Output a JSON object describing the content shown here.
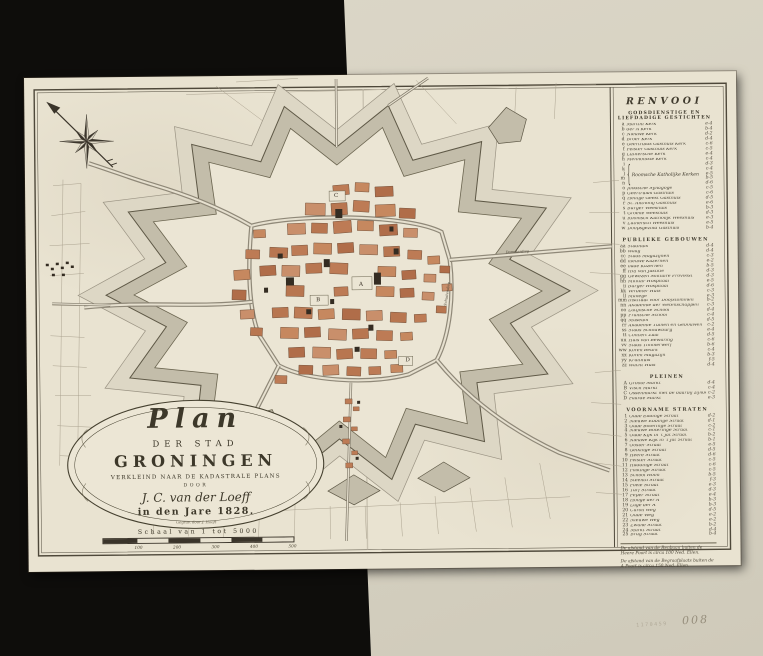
{
  "stamp": {
    "number": "1170459",
    "code": "008"
  },
  "cartouche": {
    "title_script": "Plan",
    "line_der_stad": "DER STAD",
    "city": "GRONINGEN",
    "subtitle": "VERKLEIND NAAR DE KADASTRALE PLANS",
    "door": "DOOR",
    "author": "J. C. van der Loeff",
    "year_line": "in den Jare 1828.",
    "engraver": "Gegrav. door J. Hooft",
    "scale_label": "Schaal van 1 tot 5000",
    "scale_ticks": [
      "100",
      "200",
      "300",
      "400",
      "500"
    ]
  },
  "legend": {
    "title": "RENVOOI",
    "sections": [
      {
        "header": [
          "GODSDIENSTIGE EN",
          "LIEFDADIGE GESTICHTEN"
        ],
        "items": [
          {
            "k": "a",
            "n": "Martini Kerk",
            "r": "e-4"
          },
          {
            "k": "b",
            "n": "der A Kerk",
            "r": "b-4"
          },
          {
            "k": "c",
            "n": "Nieuwe Kerk",
            "r": "d-2"
          },
          {
            "k": "d",
            "n": "Broer Kerk",
            "r": "d-4"
          },
          {
            "k": "e",
            "n": "Geertruids Gasthuis Kerk",
            "r": "c-6"
          },
          {
            "k": "f",
            "n": "Pelster Gasthuis Kerk",
            "r": "c-5"
          },
          {
            "k": "g",
            "n": "Luthersche Kerk",
            "r": "e-4"
          },
          {
            "k": "h",
            "n": "Mennoniste Kerk",
            "r": "c-4"
          }
        ],
        "group": {
          "keys": [
            "i",
            "k",
            "l",
            "m",
            "n"
          ],
          "name": "Roomsche Katholijke Kerken",
          "refs": [
            "d-3",
            "c-4",
            "e-5",
            "b-5",
            "d-6"
          ]
        },
        "items2": [
          {
            "k": "o",
            "n": "Joodsche Synagoge",
            "r": "c-5"
          },
          {
            "k": "p",
            "n": "Geertruids Gasthuis",
            "r": "c-6"
          },
          {
            "k": "q",
            "n": "Heilige Geest Gasthuis",
            "r": "d-5"
          },
          {
            "k": "r",
            "n": "St. Anthonij Gasthuis",
            "r": "e-6"
          },
          {
            "k": "s",
            "n": "Burger Weeshuis",
            "r": "b-3"
          },
          {
            "k": "t",
            "n": "Groene Weeshuis",
            "r": "d-3"
          },
          {
            "k": "u",
            "n": "Roomsch Katholijk Weeshuis",
            "r": "e-3"
          },
          {
            "k": "v",
            "n": "Luthersch Weeshuis",
            "r": "e-5"
          },
          {
            "k": "w",
            "n": "Doopsgezind Gasthuis",
            "r": "b-4"
          }
        ]
      },
      {
        "header": [
          "PUBLIEKE GEBOUWEN"
        ],
        "items": [
          {
            "k": "aa",
            "n": "Stadhuis",
            "r": "d-4"
          },
          {
            "k": "bb",
            "n": "Waag",
            "r": "d-4"
          },
          {
            "k": "cc",
            "n": "Stads Magazijnen",
            "r": "c-3"
          },
          {
            "k": "dd",
            "n": "nieuwe Kazernen",
            "r": "e-2"
          },
          {
            "k": "ee",
            "n": "oude Kazernen",
            "r": "b-5"
          },
          {
            "k": "ff",
            "n": "Hof van Justitie",
            "r": "d-3"
          },
          {
            "k": "gg",
            "n": "Gewezen Militaire Provoost",
            "r": "d-3"
          },
          {
            "k": "hh",
            "n": "Militair Hospitaal",
            "r": "e-5"
          },
          {
            "k": "ii",
            "n": "Burger Hospitaal",
            "r": "d-6"
          },
          {
            "k": "kk",
            "n": "Verbeter Huis",
            "r": "c-3"
          },
          {
            "k": "ll",
            "n": "Manege",
            "r": "e-3"
          },
          {
            "k": "mm",
            "n": "Instituut voor Doofstommen",
            "r": "b-2"
          },
          {
            "k": "nn",
            "n": "Akademie der Wetenschappen",
            "r": "c-3"
          },
          {
            "k": "oo",
            "n": "Latijnsche School",
            "r": "d-4"
          },
          {
            "k": "pp",
            "n": "Fransche School",
            "r": "c-4"
          },
          {
            "k": "qq",
            "n": "Museum",
            "r": "d-5"
          },
          {
            "k": "rr",
            "n": "Akademie Tuinen en Gebouwen",
            "r": "c-2"
          },
          {
            "k": "ss",
            "n": "Stads Schouwburg",
            "r": "e-4"
          },
          {
            "k": "tt",
            "n": "Concert Zaal",
            "r": "d-5"
          },
          {
            "k": "uu",
            "n": "Huis van Bewaring",
            "r": "c-6"
          },
          {
            "k": "vv",
            "n": "Stads Timmerwerf",
            "r": "b-6"
          },
          {
            "k": "ww",
            "n": "Koren Beurs",
            "r": "c-4"
          },
          {
            "k": "xx",
            "n": "Koren Magazijn",
            "r": "b-3"
          },
          {
            "k": "yy",
            "n": "Kruithuis",
            "r": "f-5"
          },
          {
            "k": "zz",
            "n": "Wacht Huis",
            "r": "d-4"
          }
        ]
      },
      {
        "header": [
          "PLEINEN"
        ],
        "items": [
          {
            "k": "A",
            "n": "Groote Markt",
            "r": "d-4"
          },
          {
            "k": "B",
            "n": "Visch Markt",
            "r": "c-4"
          },
          {
            "k": "C",
            "n": "Ossenmarkt met de daarbij zijnde Exercitieplaats",
            "r": "c-2"
          },
          {
            "k": "D",
            "n": "Paarde Markt",
            "r": "e-3"
          }
        ]
      },
      {
        "header": [
          "VOORNAME STRATEN"
        ],
        "items": [
          {
            "k": "1",
            "n": "Oude Ebbinge Straat",
            "r": "d-2"
          },
          {
            "k": "2",
            "n": "Nieuwe Ebbinge Straat",
            "r": "d-1"
          },
          {
            "k": "3",
            "n": "Oude Boteringe Straat",
            "r": "c-2"
          },
          {
            "k": "4",
            "n": "Nieuwe Boteringe Straat",
            "r": "c-1"
          },
          {
            "k": "5",
            "n": "Oude Kijk in 't Jat Straat",
            "r": "b-2"
          },
          {
            "k": "6",
            "n": "Nieuwe Kijk in 't Jat Straat",
            "r": "b-1"
          },
          {
            "k": "7",
            "n": "Ooster Straat",
            "r": "e-5"
          },
          {
            "k": "8",
            "n": "Gelkinge Straat",
            "r": "d-5"
          },
          {
            "k": "9",
            "n": "Heere Straat",
            "r": "d-6"
          },
          {
            "k": "10",
            "n": "Pelster Straat",
            "r": "c-5"
          },
          {
            "k": "11",
            "n": "Haddinge Straat",
            "r": "c-6"
          },
          {
            "k": "12",
            "n": "Folkinge Straat",
            "r": "c-5"
          },
          {
            "k": "13",
            "n": "School Holm",
            "r": "b-5"
          },
          {
            "k": "14",
            "n": "Steentil Straat",
            "r": "f-3"
          },
          {
            "k": "15",
            "n": "Poele Straat",
            "r": "e-3"
          },
          {
            "k": "16",
            "n": "Turf Straat",
            "r": "d-3"
          },
          {
            "k": "17",
            "n": "Peper Straat",
            "r": "e-4"
          },
          {
            "k": "18",
            "n": "Hooge der A",
            "r": "b-3"
          },
          {
            "k": "19",
            "n": "Lage der A",
            "r": "b-3"
          },
          {
            "k": "20",
            "n": "Caroli Weg",
            "r": "d-5"
          },
          {
            "k": "21",
            "n": "Oude Weg",
            "r": "e-2"
          },
          {
            "k": "22",
            "n": "Nieuwe Weg",
            "r": "e-2"
          },
          {
            "k": "23",
            "n": "Zwane Straat",
            "r": "b-2"
          },
          {
            "k": "24",
            "n": "Markt Straat",
            "r": "d-4"
          },
          {
            "k": "25",
            "n": "Brug Straat",
            "r": "b-4"
          }
        ]
      }
    ],
    "notes": [
      "De afstand van de Renbaan buiten de Heere Poort is circa 100 Ned. Ellen.",
      "De afstand van de Begraafplaats buiten de A Poort is circa 150 Ned. Ellen."
    ]
  },
  "map_markers": {
    "pleinen": [
      "A",
      "B",
      "C",
      "D"
    ]
  },
  "map_labels": [
    "Schuitendiep",
    "Damsterdiep"
  ],
  "colors": {
    "background": "#0e0d0b",
    "backing_paper": "#d8d3c3",
    "map_paper": "#e9e3d1",
    "city_block": "#bd7b55",
    "rampart": "#c3bdaa",
    "ink": "#43402f"
  }
}
